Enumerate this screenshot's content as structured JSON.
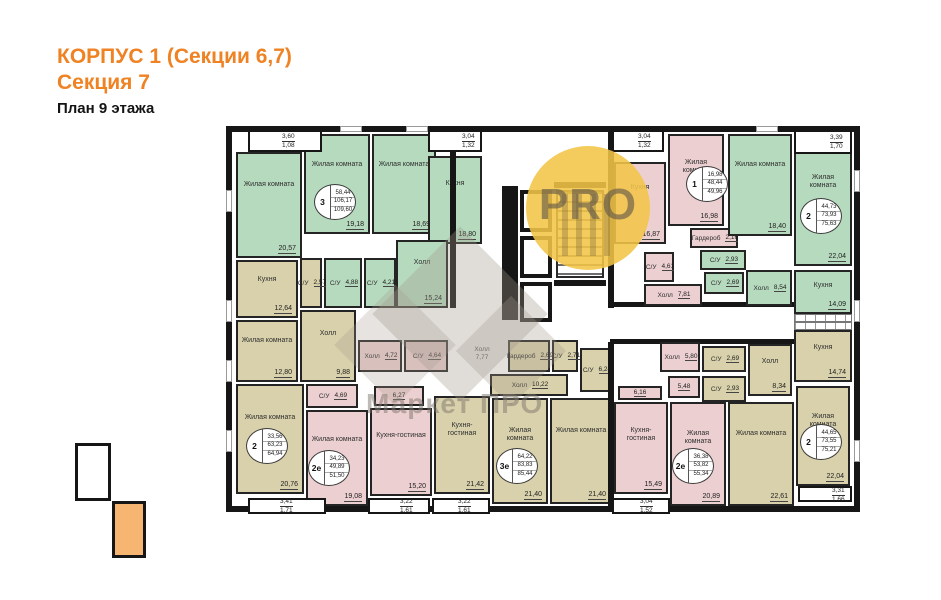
{
  "title": {
    "line1": "КОРПУС 1 (Секции 6,7)",
    "line2": "Секция 7",
    "line3": "План 9 этажа"
  },
  "watermark": {
    "circle_text": "PRO",
    "brand_text": "Маркет ПРО"
  },
  "colors": {
    "accent_orange": "#ef8222",
    "green_room": "#b6dabe",
    "pink_room": "#eccfd0",
    "beige_room": "#d8d1ab",
    "wall": "#161616",
    "legend_section_highlight": "#f6b570"
  },
  "legend": {
    "items": [
      {
        "active": false
      },
      {
        "active": true
      }
    ]
  },
  "plan": {
    "rooms": [
      {
        "name": "Жилая комната",
        "area": "20,57",
        "color": "green",
        "x": 236,
        "y": 152,
        "w": 66,
        "h": 106
      },
      {
        "name": "Жилая комната",
        "area": "19,18",
        "color": "green",
        "x": 304,
        "y": 134,
        "w": 66,
        "h": 100
      },
      {
        "name": "Жилая комната",
        "area": "18,69",
        "color": "green",
        "x": 372,
        "y": 134,
        "w": 64,
        "h": 100
      },
      {
        "name": "Кухня",
        "area": "18,80",
        "color": "green",
        "x": 428,
        "y": 156,
        "w": 54,
        "h": 88
      },
      {
        "name": "Холл",
        "area": "15,24",
        "color": "green",
        "x": 396,
        "y": 240,
        "w": 52,
        "h": 68
      },
      {
        "name": "С/У",
        "area": "4,88",
        "color": "green",
        "x": 324,
        "y": 258,
        "w": 38,
        "h": 50
      },
      {
        "name": "С/У",
        "area": "4,21",
        "color": "green",
        "x": 364,
        "y": 258,
        "w": 32,
        "h": 50
      },
      {
        "name": "Кухня",
        "area": "12,64",
        "color": "beige",
        "x": 236,
        "y": 260,
        "w": 62,
        "h": 58
      },
      {
        "name": "С/У",
        "area": "2,57",
        "color": "beige",
        "x": 300,
        "y": 258,
        "w": 22,
        "h": 50
      },
      {
        "name": "Жилая комната",
        "area": "12,80",
        "color": "beige",
        "x": 236,
        "y": 320,
        "w": 62,
        "h": 62
      },
      {
        "name": "Холл",
        "area": "9,88",
        "color": "beige",
        "x": 300,
        "y": 310,
        "w": 56,
        "h": 72
      },
      {
        "name": "Жилая комната",
        "area": "20,76",
        "color": "beige",
        "x": 236,
        "y": 384,
        "w": 68,
        "h": 110
      },
      {
        "name": "С/У",
        "area": "4,69",
        "color": "pink",
        "x": 306,
        "y": 384,
        "w": 52,
        "h": 24
      },
      {
        "name": "Холл",
        "area": "4,72",
        "color": "pink",
        "x": 358,
        "y": 340,
        "w": 44,
        "h": 32
      },
      {
        "name": "С/У",
        "area": "4,64",
        "color": "pink",
        "x": 404,
        "y": 340,
        "w": 44,
        "h": 32
      },
      {
        "name": "Жилая комната",
        "area": "19,08",
        "color": "pink",
        "x": 306,
        "y": 410,
        "w": 62,
        "h": 96
      },
      {
        "name": "Кухня-гостиная",
        "area": "15,20",
        "color": "pink",
        "x": 370,
        "y": 408,
        "w": 62,
        "h": 88
      },
      {
        "name": "",
        "area": "6,27",
        "color": "pink",
        "x": 374,
        "y": 386,
        "w": 50,
        "h": 20
      },
      {
        "name": "Кухня-гостиная",
        "area": "21,42",
        "color": "beige",
        "x": 434,
        "y": 396,
        "w": 56,
        "h": 98
      },
      {
        "name": "Жилая комната",
        "area": "21,40",
        "color": "beige",
        "x": 492,
        "y": 398,
        "w": 56,
        "h": 106
      },
      {
        "name": "Жилая комната",
        "area": "21,40",
        "color": "beige",
        "x": 550,
        "y": 398,
        "w": 62,
        "h": 106
      },
      {
        "name": "Холл",
        "area": "10,22",
        "color": "beige",
        "x": 490,
        "y": 374,
        "w": 78,
        "h": 22
      },
      {
        "name": "Гардероб",
        "area": "2,69",
        "color": "beige",
        "x": 508,
        "y": 340,
        "w": 42,
        "h": 32
      },
      {
        "name": "С/У",
        "area": "2,71",
        "color": "beige",
        "x": 552,
        "y": 340,
        "w": 26,
        "h": 32
      },
      {
        "name": "С/У",
        "area": "6,24",
        "color": "beige",
        "x": 580,
        "y": 348,
        "w": 32,
        "h": 44
      },
      {
        "name": "Кухня-гостиная",
        "area": "15,49",
        "color": "pink",
        "x": 614,
        "y": 402,
        "w": 54,
        "h": 92
      },
      {
        "name": "",
        "area": "6,16",
        "color": "pink",
        "x": 618,
        "y": 386,
        "w": 44,
        "h": 14
      },
      {
        "name": "Жилая комната",
        "area": "20,89",
        "color": "pink",
        "x": 670,
        "y": 402,
        "w": 56,
        "h": 104
      },
      {
        "name": "Холл",
        "area": "5,80",
        "color": "pink",
        "x": 660,
        "y": 342,
        "w": 40,
        "h": 30
      },
      {
        "name": "",
        "area": "5,48",
        "color": "pink",
        "x": 668,
        "y": 376,
        "w": 32,
        "h": 22
      },
      {
        "name": "С/У",
        "area": "2,69",
        "color": "beige",
        "x": 702,
        "y": 346,
        "w": 44,
        "h": 26
      },
      {
        "name": "С/У",
        "area": "2,93",
        "color": "beige",
        "x": 702,
        "y": 376,
        "w": 44,
        "h": 26
      },
      {
        "name": "Холл",
        "area": "8,34",
        "color": "beige",
        "x": 748,
        "y": 344,
        "w": 44,
        "h": 52
      },
      {
        "name": "Жилая комната",
        "area": "22,61",
        "color": "beige",
        "x": 728,
        "y": 402,
        "w": 66,
        "h": 104
      },
      {
        "name": "Жилая комната",
        "area": "22,04",
        "color": "beige",
        "x": 796,
        "y": 386,
        "w": 54,
        "h": 100
      },
      {
        "name": "Кухня",
        "area": "14,74",
        "color": "beige",
        "x": 794,
        "y": 330,
        "w": 58,
        "h": 52
      },
      {
        "name": "Кухня",
        "area": "16,87",
        "color": "pink",
        "x": 614,
        "y": 162,
        "w": 52,
        "h": 82
      },
      {
        "name": "Жилая комната",
        "area": "16,98",
        "color": "pink",
        "x": 668,
        "y": 134,
        "w": 56,
        "h": 92
      },
      {
        "name": "Гардероб",
        "area": "2,16",
        "color": "pink",
        "x": 690,
        "y": 228,
        "w": 48,
        "h": 20
      },
      {
        "name": "С/У",
        "area": "4,61",
        "color": "pink",
        "x": 644,
        "y": 252,
        "w": 30,
        "h": 30
      },
      {
        "name": "Холл",
        "area": "7,81",
        "color": "pink",
        "x": 644,
        "y": 284,
        "w": 58,
        "h": 22
      },
      {
        "name": "С/У",
        "area": "2,93",
        "color": "green",
        "x": 700,
        "y": 250,
        "w": 46,
        "h": 20
      },
      {
        "name": "С/У",
        "area": "2,69",
        "color": "green",
        "x": 704,
        "y": 272,
        "w": 40,
        "h": 22
      },
      {
        "name": "Холл",
        "area": "8,54",
        "color": "green",
        "x": 746,
        "y": 270,
        "w": 46,
        "h": 36
      },
      {
        "name": "Жилая комната",
        "area": "18,40",
        "color": "green",
        "x": 728,
        "y": 134,
        "w": 64,
        "h": 102
      },
      {
        "name": "Жилая комната",
        "area": "22,04",
        "color": "green",
        "x": 794,
        "y": 140,
        "w": 58,
        "h": 126
      },
      {
        "name": "Кухня",
        "area": "14,09",
        "color": "green",
        "x": 794,
        "y": 270,
        "w": 58,
        "h": 44
      }
    ],
    "badges": [
      {
        "label": "3",
        "lines": [
          "58,44",
          "106,17",
          "109,60"
        ],
        "x": 314,
        "y": 184
      },
      {
        "label": "1",
        "lines": [
          "16,98",
          "48,44",
          "49,96"
        ],
        "x": 686,
        "y": 166
      },
      {
        "label": "2",
        "lines": [
          "44,73",
          "73,93",
          "75,63"
        ],
        "x": 800,
        "y": 198
      },
      {
        "label": "2",
        "lines": [
          "33,56",
          "63,23",
          "64,94"
        ],
        "x": 246,
        "y": 428
      },
      {
        "label": "2е",
        "lines": [
          "34,23",
          "49,89",
          "51,50"
        ],
        "x": 308,
        "y": 450
      },
      {
        "label": "3е",
        "lines": [
          "64,22",
          "83,83",
          "85,44"
        ],
        "x": 496,
        "y": 448
      },
      {
        "label": "2е",
        "lines": [
          "36,38",
          "53,82",
          "55,34"
        ],
        "x": 672,
        "y": 448
      },
      {
        "label": "2",
        "lines": [
          "44,65",
          "73,55",
          "75,21"
        ],
        "x": 800,
        "y": 424
      }
    ],
    "balconies": [
      {
        "v1": "3,60",
        "v2": "1,08",
        "x": 282,
        "y": 133
      },
      {
        "v1": "3,04",
        "v2": "1,32",
        "x": 462,
        "y": 133
      },
      {
        "v1": "3,04",
        "v2": "1,32",
        "x": 638,
        "y": 133
      },
      {
        "v1": "3,39",
        "v2": "1,70",
        "x": 830,
        "y": 134
      },
      {
        "v1": "3,41",
        "v2": "1,71",
        "x": 280,
        "y": 498
      },
      {
        "v1": "3,22",
        "v2": "1,61",
        "x": 400,
        "y": 498
      },
      {
        "v1": "3,22",
        "v2": "1,61",
        "x": 458,
        "y": 498
      },
      {
        "v1": "3,04",
        "v2": "1,52",
        "x": 640,
        "y": 498
      },
      {
        "v1": "3,31",
        "v2": "1,66",
        "x": 832,
        "y": 487
      }
    ],
    "corridor_labels": [
      {
        "name": "Холл",
        "area": "7,77",
        "x": 458,
        "y": 340,
        "w": 48,
        "h": 28
      }
    ]
  }
}
